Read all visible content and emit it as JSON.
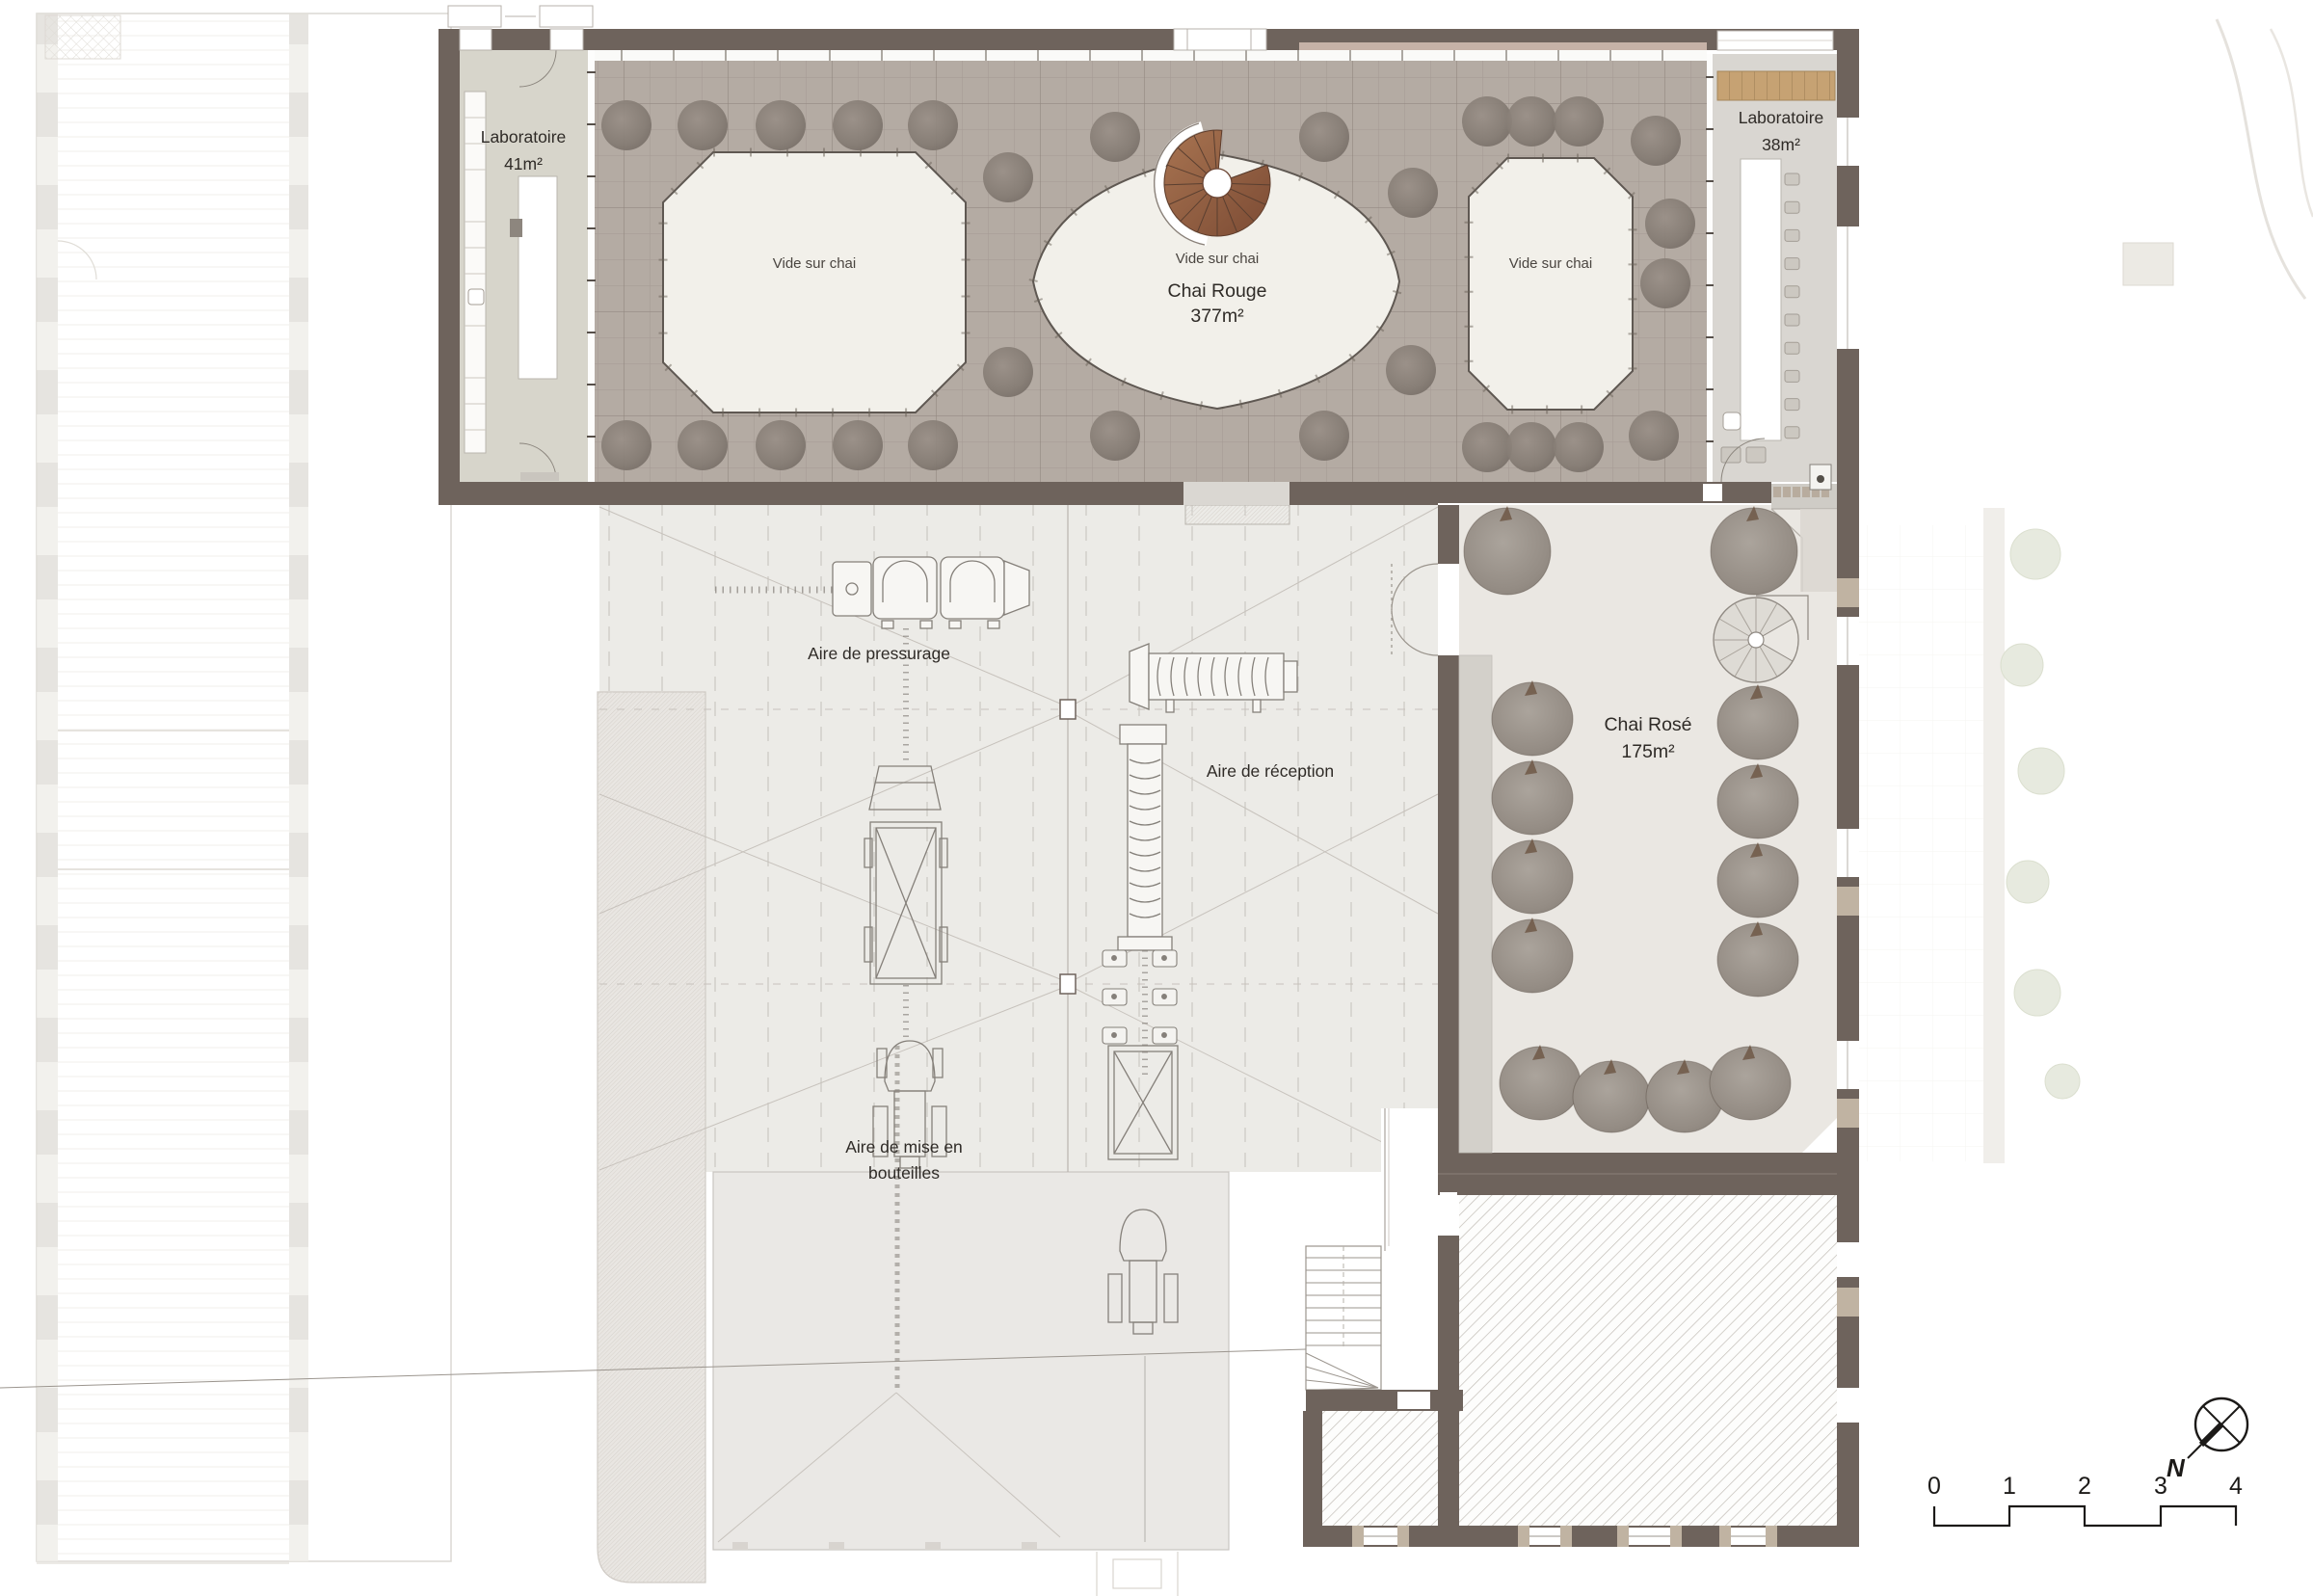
{
  "labels": {
    "lab41_name": "Laboratoire",
    "lab41_area": "41m²",
    "vide1": "Vide sur chai",
    "vide2": "Vide sur chai",
    "vide3": "Vide sur chai",
    "chai_rouge_name": "Chai Rouge",
    "chai_rouge_area": "377m²",
    "lab38_name": "Laboratoire",
    "lab38_area": "38m²",
    "chai_rose_name": "Chai Rosé",
    "chai_rose_area": "175m²",
    "pressurage": "Aire de pressurage",
    "reception": "Aire de réception",
    "bouteilles_l1": "Aire de mise en",
    "bouteilles_l2": "bouteilles"
  },
  "scale_bar": {
    "ticks": [
      "0",
      "1",
      "2",
      "3",
      "4"
    ]
  },
  "compass": {
    "label": "N"
  },
  "colors": {
    "wall": "#6e635c",
    "hall_floor": "#b4aba3",
    "void_fill": "#f2f0ea",
    "lab41_floor": "#d7d5cb",
    "lab38_floor": "#d9d6d1",
    "wood_cabinet": "#c6a273",
    "stair_wood": "#96674c",
    "rose_floor": "#eae7e2",
    "tank_gray": "#857c74",
    "hatch_line": "#c6c1bb"
  }
}
